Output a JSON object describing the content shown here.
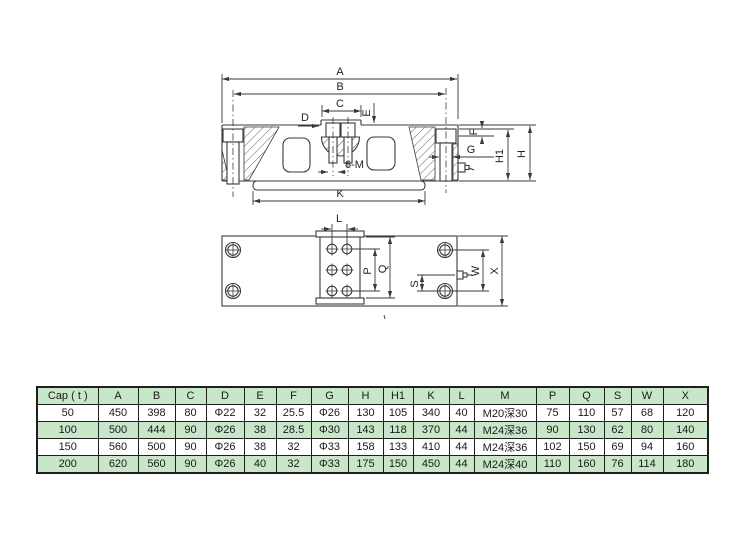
{
  "drawing": {
    "labels": {
      "A": "A",
      "B": "B",
      "C": "C",
      "D": "D",
      "E": "E",
      "F": "F",
      "G": "G",
      "H": "H",
      "H1": "H1",
      "K": "K",
      "sixM": "6-M",
      "L": "L",
      "P": "P",
      "Q": "Q",
      "S": "S",
      "W": "W",
      "X": "X"
    }
  },
  "table": {
    "columns": [
      "Cap ( t )",
      "A",
      "B",
      "C",
      "D",
      "E",
      "F",
      "G",
      "H",
      "H1",
      "K",
      "L",
      "M",
      "P",
      "Q",
      "S",
      "W",
      "X"
    ],
    "rows": [
      [
        "50",
        "450",
        "398",
        "80",
        "Φ22",
        "32",
        "25.5",
        "Φ26",
        "130",
        "105",
        "340",
        "40",
        "M20深30",
        "75",
        "110",
        "57",
        "68",
        "120"
      ],
      [
        "100",
        "500",
        "444",
        "90",
        "Φ26",
        "38",
        "28.5",
        "Φ30",
        "143",
        "118",
        "370",
        "44",
        "M24深36",
        "90",
        "130",
        "62",
        "80",
        "140"
      ],
      [
        "150",
        "560",
        "500",
        "90",
        "Φ26",
        "38",
        "32",
        "Φ33",
        "158",
        "133",
        "410",
        "44",
        "M24深36",
        "102",
        "150",
        "69",
        "94",
        "160"
      ],
      [
        "200",
        "620",
        "560",
        "90",
        "Φ26",
        "40",
        "32",
        "Φ33",
        "175",
        "150",
        "450",
        "44",
        "M24深40",
        "110",
        "160",
        "76",
        "114",
        "180"
      ]
    ]
  },
  "colors": {
    "accent_green": "#c8e6c8",
    "line_color": "#3a3a3a"
  }
}
